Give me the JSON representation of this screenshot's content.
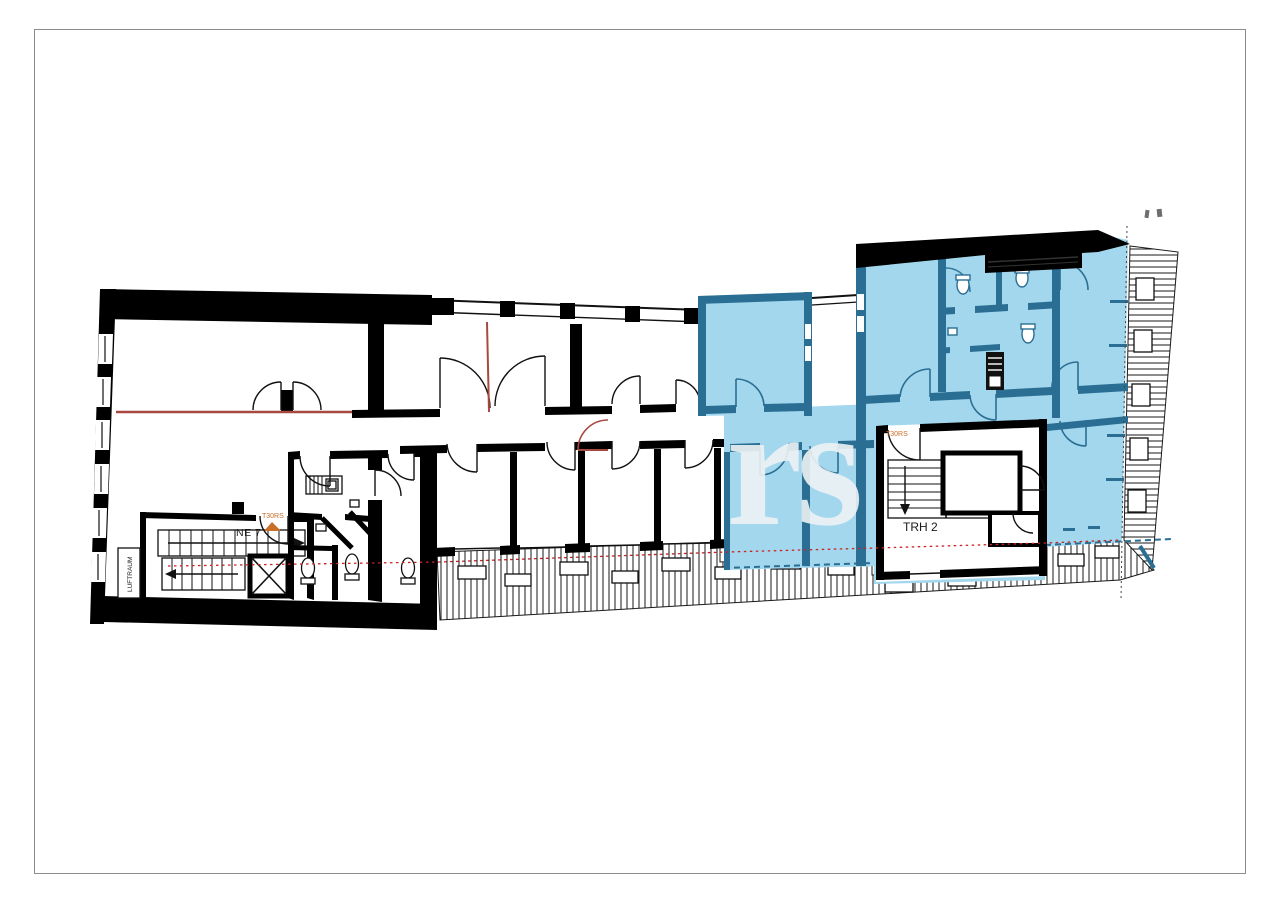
{
  "page": {
    "background": "#ffffff"
  },
  "watermark": {
    "text": "rs"
  },
  "floor_plan": {
    "labels": {
      "unit_label": "NE 7",
      "stairwell_label": "TRH 2",
      "void_label": "LUFTRAUM",
      "fire_door_label_left": "T30RS",
      "fire_door_label_right": "T30RS"
    },
    "colors": {
      "wall": "#000000",
      "highlight_fill": "#a3d7ee",
      "highlight_wall": "#2b6e93",
      "fire_line_red": "#a84840",
      "escape_route_red": "#cc2222",
      "fire_door_orange": "#c86f28",
      "watermark": "#eef2f4",
      "page_border": "#8c8c8c",
      "hatch_line": "#1a1a1a"
    }
  }
}
